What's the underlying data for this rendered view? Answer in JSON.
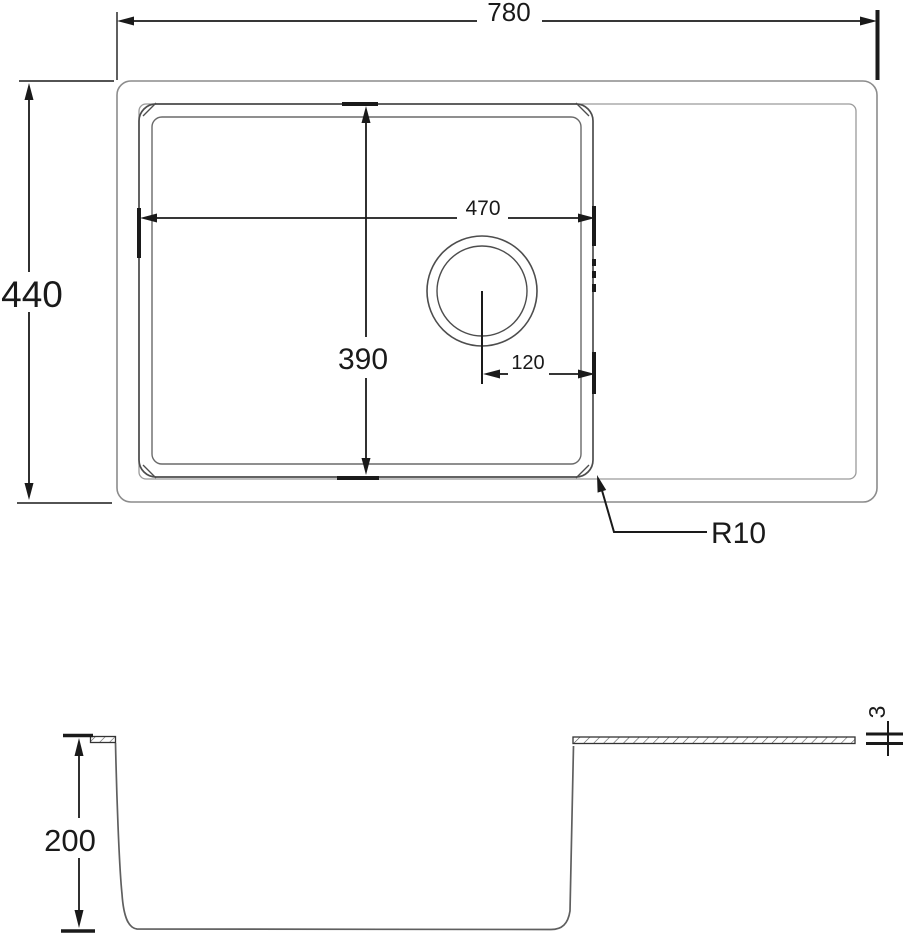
{
  "drawing_type": "sink-technical-drawing",
  "dims": {
    "overall_width": "780",
    "overall_depth": "440",
    "bowl_width": "470",
    "bowl_depth": "390",
    "drain_to_edge": "120",
    "corner_radius": "R10",
    "bowl_height": "200",
    "rim_thickness": "3"
  },
  "colors": {
    "background": "#ffffff",
    "dimension_lines": "#1a1a1a",
    "outer_outline": "#8c8c8c",
    "bowl_outline": "#4d4d4d",
    "section_profile": "#5f5f5f"
  }
}
